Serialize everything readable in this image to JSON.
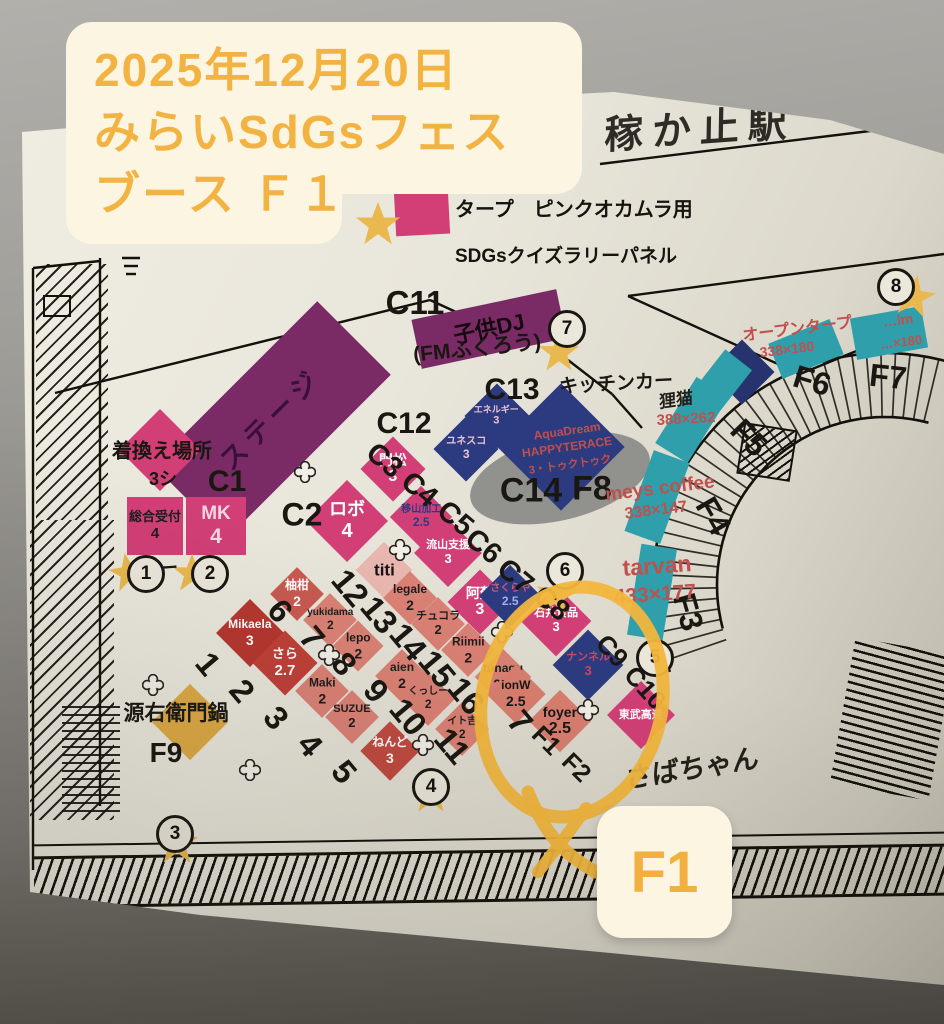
{
  "overlay_note": {
    "line1": "2025年12月20日",
    "line2": "みらいSdGsフェス",
    "line3": "ブース Ｆ１",
    "text_color": "#f2b342",
    "bg_color": "#fbf5e2"
  },
  "result_badge": {
    "label": "F1",
    "text_color": "#f1b040",
    "bg_color": "#fbf5e2"
  },
  "legend": {
    "tarp_label": "タープ　ピンクオカムラ用",
    "tarp_color": "#d23f77",
    "star_label": "SDGsクイズラリーパネル",
    "star_color": "#e9b84e"
  },
  "station_header": {
    "text": "稼か止駅"
  },
  "annotation": {
    "circle_color": "#f2b63c"
  },
  "hand_notes": [
    {
      "text": "狸猫",
      "cx": 676,
      "cy": 398,
      "fs": 17,
      "rot": -8
    },
    {
      "text": "さばちゃん",
      "cx": 692,
      "cy": 766,
      "fs": 27,
      "rot": -9
    }
  ],
  "booths": [
    {
      "id": "stage",
      "label": "ステージ",
      "cx": 272,
      "cy": 420,
      "w": 232,
      "h": 104,
      "rot": -45,
      "bg": "#7a2b66",
      "fg": "#3a0f3d",
      "fs": 27,
      "ls": 6,
      "counter": false,
      "bold": true
    },
    {
      "id": "kids-dj",
      "label": "子供DJ",
      "cx": 489,
      "cy": 329,
      "w": 148,
      "h": 50,
      "rot": -12,
      "bg": "#7a2b66",
      "fg": "#15090f",
      "fs": 22,
      "counter": false,
      "bold": true
    },
    {
      "id": "kigae-basho",
      "cx": 160,
      "cy": 450,
      "s": 58,
      "rot": 45,
      "bg": "#d23f77"
    },
    {
      "id": "sogo-uketsuke",
      "label": "総合受付",
      "sub": "4",
      "cx": 155,
      "cy": 526,
      "w": 56,
      "h": 58,
      "rot": 0,
      "bg": "#d23f77",
      "fg": "#1d1d1d",
      "fs": 13,
      "bold": true
    },
    {
      "id": "mk",
      "label": "MK",
      "sub": "4",
      "cx": 216,
      "cy": 526,
      "w": 60,
      "h": 58,
      "rot": 0,
      "bg": "#d23f77",
      "fg": "#f6d6e4",
      "fs": 19
    },
    {
      "id": "robo",
      "label": "ロボ",
      "sub": "4",
      "cx": 347,
      "cy": 521,
      "s": 58,
      "rot": 45,
      "bg": "#d23f77",
      "fg": "#ffffff",
      "fs": 18,
      "bold": true
    },
    {
      "id": "kadomatsu",
      "label": "門松",
      "sub": "3",
      "cx": 393,
      "cy": 469,
      "s": 46,
      "rot": 45,
      "bg": "#d23f77",
      "fg": "#ffffff",
      "fs": 14,
      "bold": true
    },
    {
      "id": "kakou",
      "label": "移山加工",
      "sub": "2.5",
      "cx": 421,
      "cy": 517,
      "s": 44,
      "rot": 45,
      "bg": "#d23f77",
      "fg": "#2c3a80",
      "fs": 10
    },
    {
      "id": "nagareyama-shien",
      "label": "流山支援",
      "sub": "3",
      "cx": 448,
      "cy": 553,
      "s": 48,
      "rot": 45,
      "bg": "#d23f77",
      "fg": "#ffffff",
      "fs": 11
    },
    {
      "id": "aso",
      "label": "阿蘇",
      "sub": "3",
      "cx": 480,
      "cy": 602,
      "s": 46,
      "rot": 45,
      "bg": "#d23f77",
      "fg": "#ffffff",
      "fs": 14
    },
    {
      "id": "ishii-foods",
      "label": "石井食品",
      "sub": "3",
      "cx": 556,
      "cy": 621,
      "s": 50,
      "rot": 45,
      "bg": "#d23f77",
      "fg": "#ffffff",
      "fs": 11
    },
    {
      "id": "tobu-kosoku",
      "label": "東武高速",
      "cx": 641,
      "cy": 715,
      "s": 48,
      "rot": 45,
      "bg": "#d23f77",
      "fg": "#ffffff",
      "fs": 11
    },
    {
      "id": "energy",
      "label": "エネルギー",
      "sub": "3",
      "cx": 497,
      "cy": 416,
      "s": 46,
      "rot": 45,
      "bg": "#2c3a80",
      "fg": "#eec3d2",
      "fs": 9
    },
    {
      "id": "unesco",
      "label": "ユネスコ",
      "sub": "3",
      "cx": 466,
      "cy": 449,
      "s": 46,
      "rot": 45,
      "bg": "#2c3a80",
      "fg": "#eec3d2",
      "fs": 10
    },
    {
      "id": "aquadream",
      "cx": 561,
      "cy": 447,
      "s": 90,
      "rot": 45,
      "bg": "#2c3a80"
    },
    {
      "id": "sakuraya",
      "label": "さくらや",
      "sub": "2.5",
      "cx": 510,
      "cy": 596,
      "s": 44,
      "rot": 45,
      "bg": "#2c3a80",
      "fg": "#cf5a74",
      "subfg": "#9db4e8",
      "fs": 10
    },
    {
      "id": "nanneru",
      "label": "ナンネル",
      "sub": "3",
      "cx": 588,
      "cy": 665,
      "s": 50,
      "rot": 45,
      "bg": "#2c3a80",
      "fg": "#c84a62",
      "fs": 11
    },
    {
      "id": "navy-blank",
      "cx": 742,
      "cy": 372,
      "s": 46,
      "rot": 45,
      "bg": "#27336e"
    },
    {
      "id": "titi",
      "label": "titi",
      "cx": 384,
      "cy": 570,
      "s": 40,
      "rot": 45,
      "bg": "#e9b7af",
      "fg": "#151515",
      "fs": 17,
      "bold": true
    },
    {
      "id": "legale",
      "label": "legale",
      "sub": "2",
      "cx": 410,
      "cy": 598,
      "s": 38,
      "rot": 45,
      "bg": "#db8175",
      "fg": "#1d1d1d",
      "fs": 12,
      "bold": true
    },
    {
      "id": "chucola",
      "label": "チュコラ",
      "sub": "2",
      "cx": 438,
      "cy": 624,
      "s": 38,
      "rot": 45,
      "bg": "#db8175",
      "fg": "#1d1d1d",
      "fs": 11,
      "bold": true
    },
    {
      "id": "riimii",
      "label": "Riimii",
      "sub": "2",
      "cx": 468,
      "cy": 650,
      "s": 38,
      "rot": 45,
      "bg": "#db8175",
      "fg": "#1d1d1d",
      "fs": 12,
      "bold": true
    },
    {
      "id": "tunagu",
      "label": "tunagu",
      "sub": "2.2",
      "cx": 503,
      "cy": 677,
      "s": 40,
      "rot": 45,
      "bg": "#db8175",
      "fg": "#1d1d1d",
      "fs": 12,
      "bold": true
    },
    {
      "id": "yuzukan",
      "label": "柚柑",
      "sub": "2",
      "cx": 297,
      "cy": 594,
      "s": 38,
      "rot": 45,
      "bg": "#c85a50",
      "fg": "#ffffff",
      "fs": 12
    },
    {
      "id": "yukidama",
      "label": "yukidama",
      "sub": "2",
      "cx": 330,
      "cy": 620,
      "s": 38,
      "rot": 45,
      "bg": "#db8175",
      "fg": "#1d1d1d",
      "fs": 10,
      "bold": true
    },
    {
      "id": "lepo",
      "label": "lepo",
      "sub": "2",
      "cx": 358,
      "cy": 646,
      "s": 36,
      "rot": 45,
      "bg": "#db8175",
      "fg": "#1d1d1d",
      "fs": 12,
      "bold": true
    },
    {
      "id": "aien",
      "label": "aien",
      "sub": "2",
      "cx": 402,
      "cy": 676,
      "s": 38,
      "rot": 45,
      "bg": "#db8175",
      "fg": "#1d1d1d",
      "fs": 12,
      "bold": true
    },
    {
      "id": "mikaela",
      "label": "Mikaela",
      "sub": "3",
      "cx": 250,
      "cy": 633,
      "s": 48,
      "rot": 45,
      "bg": "#b5372f",
      "fg": "#ffffff",
      "fs": 12,
      "bold": true
    },
    {
      "id": "sara",
      "label": "さら",
      "sub": "2.7",
      "cx": 285,
      "cy": 663,
      "s": 46,
      "rot": 45,
      "bg": "#bf4038",
      "fg": "#ffffff",
      "fs": 13
    },
    {
      "id": "maki",
      "label": "Maki",
      "sub": "2",
      "cx": 322,
      "cy": 691,
      "s": 38,
      "rot": 45,
      "bg": "#db8175",
      "fg": "#1d1d1d",
      "fs": 12,
      "bold": true
    },
    {
      "id": "suzue",
      "label": "SUZUE",
      "sub": "2",
      "cx": 352,
      "cy": 717,
      "s": 38,
      "rot": 45,
      "bg": "#db8175",
      "fg": "#1d1d1d",
      "fs": 11,
      "bold": true
    },
    {
      "id": "kusshi",
      "label": "くっしー",
      "sub": "2",
      "cx": 428,
      "cy": 699,
      "s": 38,
      "rot": 45,
      "bg": "#db8175",
      "fg": "#1d1d1d",
      "fs": 10,
      "bold": true
    },
    {
      "id": "itoyoshi",
      "label": "イト吉",
      "sub": "2",
      "cx": 462,
      "cy": 729,
      "s": 38,
      "rot": 45,
      "bg": "#db8175",
      "fg": "#1d1d1d",
      "fs": 10,
      "bold": true
    },
    {
      "id": "nendo",
      "label": "ねんど",
      "sub": "3",
      "cx": 390,
      "cy": 751,
      "s": 42,
      "rot": 45,
      "bg": "#c04a40",
      "fg": "#ffffff",
      "fs": 12
    },
    {
      "id": "foyer",
      "label": "foyer",
      "sub": "2.5",
      "cx": 560,
      "cy": 721,
      "s": 44,
      "rot": 45,
      "bg": "#d97e6f",
      "fg": "#161616",
      "fs": 14,
      "bold": true
    },
    {
      "id": "ionw",
      "label": "ionW",
      "sub": "2.5",
      "cx": 516,
      "cy": 694,
      "s": 42,
      "rot": 45,
      "bg": "#d97e6f",
      "fg": "#161616",
      "fs": 12,
      "bold": true
    },
    {
      "id": "genemon-nabe",
      "cx": 190,
      "cy": 722,
      "s": 54,
      "rot": 45,
      "bg": "#dda945"
    },
    {
      "id": "teal-1",
      "cx": 692,
      "cy": 420,
      "w": 38,
      "h": 78,
      "rot": 32,
      "bg": "#2f9fac"
    },
    {
      "id": "teal-2",
      "cx": 657,
      "cy": 497,
      "w": 38,
      "h": 86,
      "rot": 20,
      "bg": "#2f9fac"
    },
    {
      "id": "teal-3",
      "cx": 652,
      "cy": 592,
      "w": 36,
      "h": 92,
      "rot": 9,
      "bg": "#2f9fac"
    },
    {
      "id": "teal-4",
      "cx": 806,
      "cy": 349,
      "w": 66,
      "h": 38,
      "rot": -22,
      "bg": "#2f9fac"
    },
    {
      "id": "teal-5",
      "cx": 889,
      "cy": 333,
      "w": 72,
      "h": 42,
      "rot": -10,
      "bg": "#2f9fac"
    },
    {
      "id": "teal-6",
      "cx": 722,
      "cy": 381,
      "w": 34,
      "h": 54,
      "rot": 38,
      "bg": "#2f9fac"
    }
  ],
  "map_labels": [
    [
      "C11",
      415,
      303,
      33,
      0
    ],
    [
      "C13",
      512,
      390,
      30,
      0
    ],
    [
      "C12",
      404,
      424,
      30,
      0
    ],
    [
      "C14",
      531,
      491,
      34,
      0
    ],
    [
      "F8",
      592,
      489,
      34,
      0
    ],
    [
      "C1",
      227,
      482,
      30,
      0
    ],
    [
      "C2",
      302,
      515,
      32,
      0
    ],
    [
      "C3",
      384,
      461,
      29,
      40
    ],
    [
      "C4",
      419,
      490,
      29,
      40
    ],
    [
      "C5",
      455,
      519,
      29,
      40
    ],
    [
      "C6",
      483,
      547,
      29,
      40
    ],
    [
      "C7",
      515,
      577,
      29,
      40
    ],
    [
      "C8",
      551,
      604,
      29,
      40
    ],
    [
      "C9",
      612,
      651,
      26,
      48
    ],
    [
      "C10",
      645,
      688,
      26,
      48
    ],
    [
      "F1",
      546,
      741,
      25,
      45
    ],
    [
      "F2",
      576,
      768,
      25,
      45
    ],
    [
      "F3",
      688,
      612,
      32,
      74
    ],
    [
      "F4",
      713,
      516,
      32,
      60
    ],
    [
      "F5",
      749,
      438,
      32,
      46
    ],
    [
      "F6",
      812,
      381,
      32,
      17
    ],
    [
      "F7",
      888,
      377,
      32,
      6
    ],
    [
      "キッチンカー",
      616,
      382,
      19,
      -3
    ],
    [
      "(FMふくろう)",
      477,
      347,
      21,
      -6
    ],
    [
      "着換え場所",
      162,
      449,
      20,
      0
    ],
    [
      "3シ",
      163,
      478,
      18,
      0
    ],
    [
      "源右衛門鍋",
      176,
      712,
      21,
      0
    ],
    [
      "F9",
      166,
      753,
      28,
      0
    ],
    [
      "12",
      350,
      588,
      33,
      50
    ],
    [
      "13",
      379,
      615,
      33,
      50
    ],
    [
      "14",
      408,
      642,
      33,
      50
    ],
    [
      "15",
      437,
      669,
      33,
      50
    ],
    [
      "16",
      466,
      696,
      33,
      50
    ],
    [
      "7",
      520,
      722,
      33,
      50
    ],
    [
      "6",
      280,
      611,
      33,
      50
    ],
    [
      "7",
      312,
      638,
      33,
      50
    ],
    [
      "8",
      344,
      664,
      33,
      50
    ],
    [
      "9",
      376,
      691,
      33,
      50
    ],
    [
      "10",
      408,
      717,
      33,
      50
    ],
    [
      "11",
      452,
      746,
      33,
      50
    ],
    [
      "1",
      208,
      664,
      33,
      50
    ],
    [
      "2",
      242,
      691,
      33,
      50
    ],
    [
      "3",
      276,
      718,
      33,
      50
    ],
    [
      "4",
      310,
      745,
      33,
      50
    ],
    [
      "5",
      344,
      772,
      33,
      50
    ],
    [
      "ー",
      169,
      567,
      18,
      -4
    ]
  ],
  "red_texts": [
    [
      "meys  coffee",
      660,
      489,
      19,
      -7,
      true
    ],
    [
      "338×147",
      656,
      511,
      16,
      -7,
      true
    ],
    [
      "tarvan",
      657,
      566,
      23,
      -4,
      true
    ],
    [
      "433×177",
      655,
      595,
      21,
      -4,
      true
    ],
    [
      "オープンタープ",
      797,
      327,
      16,
      -7,
      true
    ],
    [
      "338×180",
      787,
      349,
      14,
      -7,
      true
    ],
    [
      "…lm",
      898,
      320,
      14,
      -7,
      true
    ],
    [
      "…×180",
      901,
      342,
      13,
      -7,
      true
    ],
    [
      "388×262",
      686,
      419,
      15,
      -3,
      false
    ],
    [
      "AquaDream",
      567,
      431,
      12,
      -8,
      true
    ],
    [
      "HAPPYTERACE",
      567,
      447,
      12,
      -8,
      true
    ],
    [
      "3・トゥクトゥク",
      570,
      464,
      11,
      -8,
      true
    ]
  ],
  "circled_numbers": [
    {
      "n": "1",
      "cx": 143,
      "cy": 571
    },
    {
      "n": "2",
      "cx": 207,
      "cy": 571
    },
    {
      "n": "3",
      "cx": 172,
      "cy": 831
    },
    {
      "n": "4",
      "cx": 428,
      "cy": 784
    },
    {
      "n": "5",
      "cx": 652,
      "cy": 655
    },
    {
      "n": "6",
      "cx": 562,
      "cy": 568
    },
    {
      "n": "7",
      "cx": 564,
      "cy": 326
    },
    {
      "n": "8",
      "cx": 893,
      "cy": 284
    }
  ],
  "stars": [
    [
      378,
      224,
      46,
      0
    ],
    [
      128,
      572,
      40,
      -10
    ],
    [
      192,
      573,
      40,
      0
    ],
    [
      177,
      843,
      44,
      0
    ],
    [
      431,
      793,
      42,
      0
    ],
    [
      556,
      595,
      42,
      8
    ],
    [
      559,
      352,
      42,
      0
    ],
    [
      914,
      296,
      44,
      10
    ]
  ],
  "flowers": [
    [
      305,
      472
    ],
    [
      400,
      550
    ],
    [
      502,
      632
    ],
    [
      329,
      655
    ],
    [
      153,
      685
    ],
    [
      250,
      770
    ],
    [
      423,
      745
    ],
    [
      588,
      710
    ]
  ],
  "lines": [
    [
      55,
      393,
      430,
      300
    ],
    [
      430,
      300,
      508,
      336
    ],
    [
      568,
      360,
      612,
      394
    ],
    [
      612,
      394,
      642,
      428
    ],
    [
      628,
      296,
      944,
      254
    ],
    [
      628,
      296,
      800,
      374
    ],
    [
      800,
      374,
      908,
      330
    ],
    [
      600,
      164,
      878,
      130
    ],
    [
      33,
      268,
      33,
      870
    ],
    [
      100,
      258,
      100,
      806
    ],
    [
      33,
      268,
      100,
      261
    ],
    [
      122,
      258,
      140,
      258
    ],
    [
      124,
      266,
      138,
      266
    ],
    [
      126,
      274,
      136,
      274
    ]
  ],
  "map_ink": "#14110c"
}
